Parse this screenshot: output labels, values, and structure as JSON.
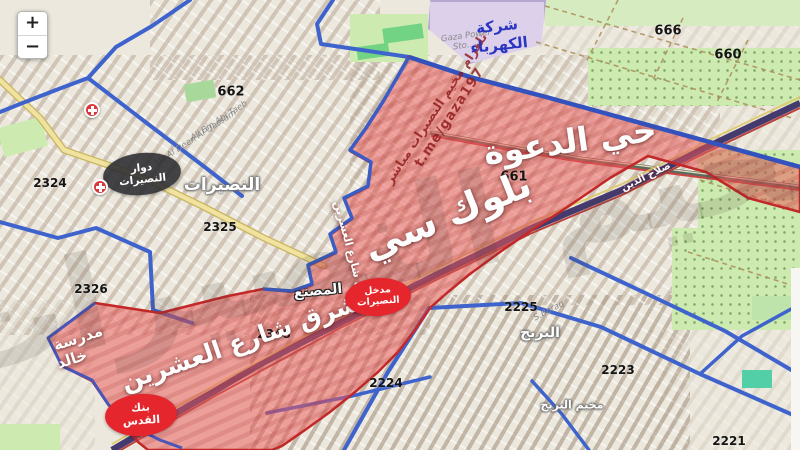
{
  "app": {
    "type": "interactive-map",
    "region": "Nuseirat / Bureij"
  },
  "controls": {
    "zoom_in": "+",
    "zoom_out": "−"
  },
  "watermarks": {
    "telegram_line1": "تلغرام مخيم النصيرات مباشر",
    "telegram_line2": "t.me/gaza197",
    "big_gray": "مخيم النصيرات"
  },
  "map": {
    "block_numbers": [
      {
        "text": "662",
        "x": 231,
        "y": 92,
        "size": 13
      },
      {
        "text": "666",
        "x": 668,
        "y": 31,
        "size": 13
      },
      {
        "text": "660",
        "x": 728,
        "y": 55,
        "size": 13
      },
      {
        "text": "661",
        "x": 514,
        "y": 177,
        "size": 13
      },
      {
        "text": "2324",
        "x": 50,
        "y": 183,
        "size": 12
      },
      {
        "text": "2325",
        "x": 220,
        "y": 227,
        "size": 12
      },
      {
        "text": "2326",
        "x": 91,
        "y": 289,
        "size": 12
      },
      {
        "text": "2348",
        "x": 274,
        "y": 334,
        "size": 12
      },
      {
        "text": "2224",
        "x": 386,
        "y": 383,
        "size": 12
      },
      {
        "text": "2225",
        "x": 521,
        "y": 307,
        "size": 12
      },
      {
        "text": "2223",
        "x": 618,
        "y": 370,
        "size": 12
      },
      {
        "text": "2221",
        "x": 729,
        "y": 441,
        "size": 12
      }
    ],
    "city_labels": [
      {
        "text": "النصيرات",
        "x": 222,
        "y": 185,
        "size": 17
      },
      {
        "text": "البريج",
        "x": 540,
        "y": 333,
        "size": 14
      },
      {
        "text": "مخيم البريج",
        "x": 572,
        "y": 405,
        "size": 11
      }
    ],
    "area_labels": [
      {
        "text": "حي الدعوة",
        "x": 570,
        "y": 141,
        "size": 33,
        "rot": -8,
        "outline": false
      },
      {
        "text": "بلوك سي",
        "x": 447,
        "y": 215,
        "size": 38,
        "rot": -22,
        "outline": false
      },
      {
        "text": "شرق شارع العشرين",
        "x": 240,
        "y": 342,
        "size": 25,
        "rot": -19,
        "outline": false
      },
      {
        "text": "المصنع",
        "x": 318,
        "y": 291,
        "size": 14,
        "rot": -5,
        "outline": true
      },
      {
        "text": "مدرسة",
        "x": 78,
        "y": 338,
        "size": 15,
        "rot": -18,
        "outline": false
      },
      {
        "text": "خالد",
        "x": 72,
        "y": 359,
        "size": 15,
        "rot": -18,
        "outline": false
      },
      {
        "text": "مدخل شارع العشرين",
        "x": 352,
        "y": 256,
        "size": 11,
        "rot": 75,
        "outline": false
      },
      {
        "text": "صلاح الدين",
        "x": 646,
        "y": 177,
        "size": 10,
        "rot": -26,
        "outline": false
      }
    ],
    "street_labels": [
      {
        "text": "Gaza Power",
        "x": 466,
        "y": 36,
        "rot": -8
      },
      {
        "text": "Sto...",
        "x": 464,
        "y": 46,
        "rot": -8
      },
      {
        "text": "Ali Bin Abi Taeb",
        "x": 219,
        "y": 121,
        "rot": -33
      },
      {
        "text": "Uz Al Deen Al Qassam",
        "x": 196,
        "y": 138,
        "rot": -33
      },
      {
        "text": "S.Boraq",
        "x": 549,
        "y": 311,
        "rot": -28
      }
    ],
    "poi_labels": [
      {
        "text": "شركة",
        "x": 497,
        "y": 26,
        "size": 15,
        "rot": -6,
        "color": "#2a36c0"
      },
      {
        "text": "الكهرباء",
        "x": 499,
        "y": 45,
        "size": 15,
        "rot": -6,
        "color": "#2a36c0"
      }
    ],
    "badges": [
      {
        "name": "nuseirat-roundabout-badge",
        "lines": [
          "دوار",
          "النصيرات"
        ],
        "x": 142,
        "y": 174,
        "w": 78,
        "h": 42,
        "bg": "rgba(42,42,48,0.88)",
        "rot": -6,
        "fs": 10.5
      },
      {
        "name": "nuseirat-entrance-badge",
        "lines": [
          "مدخل",
          "النصيرات"
        ],
        "x": 378,
        "y": 297,
        "w": 66,
        "h": 38,
        "bg": "#e5262d",
        "rot": -4,
        "fs": 9.5
      },
      {
        "name": "quds-bank-badge",
        "lines": [
          "بنك",
          "القدس"
        ],
        "x": 141,
        "y": 415,
        "w": 72,
        "h": 42,
        "bg": "#e5262d",
        "rot": -4,
        "fs": 11
      }
    ],
    "hospital_markers": [
      {
        "x": 92,
        "y": 110
      },
      {
        "x": 100,
        "y": 187
      }
    ]
  },
  "colors": {
    "zone_fill": "#eb5a5a",
    "zone_border": "#c42828",
    "road_blue": "#3e63cc",
    "road_yellow": "#f0e3a0",
    "highway_purple": "#453a6e",
    "green": "#cdebb0",
    "station_purple": "#ddd0eb"
  }
}
